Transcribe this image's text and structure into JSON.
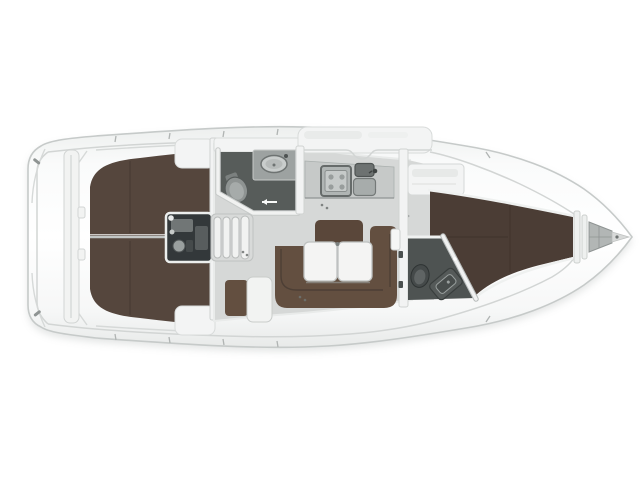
{
  "meta": {
    "type": "yacht-interior-floor-plan",
    "view": "top-down",
    "orientation": "bow-pointing-right",
    "visible_text": "none"
  },
  "palette": {
    "page_bg": "#ffffff",
    "hull_outline": "#c6cac9",
    "shadow": "#9aa09f",
    "floor": "#d6d8d7",
    "counter": "#c6c9c8",
    "wet_floor": "#575c5a",
    "wet_floor_fwd": "#4e5352",
    "berth_aft": "#55463d",
    "berth_fwd": "#4b3d35",
    "settee": "#634f40",
    "backrest": "#5a473a",
    "table": "#f4f4f3",
    "engine": "#33383a",
    "steps": "#f1f2f1",
    "white_furniture": "#f3f4f4",
    "fixture": "#9da2a1",
    "locker": "#b2b6b5"
  },
  "regions": [
    {
      "id": "transom-cockpit",
      "label": "stern transom / cockpit"
    },
    {
      "id": "aft-cabin-port",
      "label": "aft double berth (port)"
    },
    {
      "id": "aft-cabin-starboard",
      "label": "aft double berth (starboard)"
    },
    {
      "id": "engine-compartment",
      "label": "engine under companionway"
    },
    {
      "id": "companionway-steps",
      "label": "companionway steps"
    },
    {
      "id": "aft-head",
      "label": "aft bathroom with toilet and washbasin"
    },
    {
      "id": "galley",
      "label": "galley with stove and twin sinks"
    },
    {
      "id": "salon",
      "label": "salon with U-settee and folding table"
    },
    {
      "id": "forward-head",
      "label": "forward bathroom with toilet and washbasin"
    },
    {
      "id": "forward-cabin",
      "label": "forward V-berth cabin"
    },
    {
      "id": "anchor-locker",
      "label": "bow anchor locker"
    }
  ]
}
